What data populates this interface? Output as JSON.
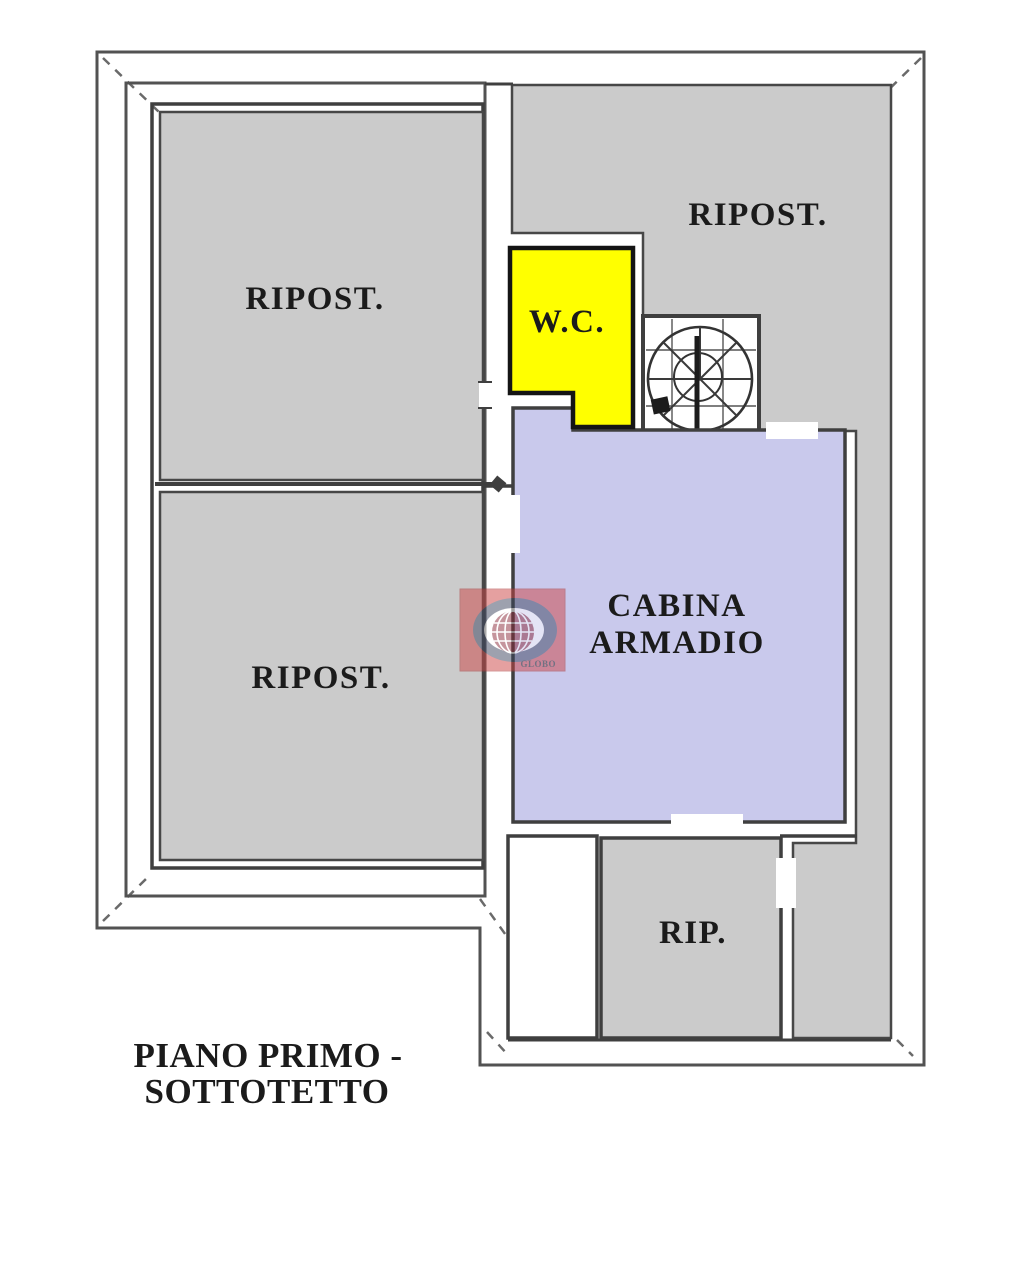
{
  "plan": {
    "type": "floor-plan",
    "floor_caption": {
      "line1": "PIANO PRIMO -",
      "line2": "SOTTOTETTO"
    },
    "rooms": {
      "ripost_top_left": {
        "label": "RIPOST."
      },
      "ripost_bottom_left": {
        "label": "RIPOST."
      },
      "ripost_top_right": {
        "label": "RIPOST."
      },
      "wc": {
        "label": "W.C."
      },
      "cabina_armadio": {
        "line1": "CABINA",
        "line2": "ARMADIO"
      },
      "rip": {
        "label": "RIP."
      }
    },
    "watermark": {
      "text": "GLOBO"
    }
  },
  "colors": {
    "room_gray": "#cbcbcb",
    "wc_yellow": "#ffff00",
    "cabina_lavender": "#c9c9ec",
    "stair_white": "#ffffff",
    "caption_red": "#d31d1d",
    "watermark_red": "#cc4444",
    "watermark_navy": "#3d4660",
    "watermark_globe": "#8c2c3c"
  }
}
